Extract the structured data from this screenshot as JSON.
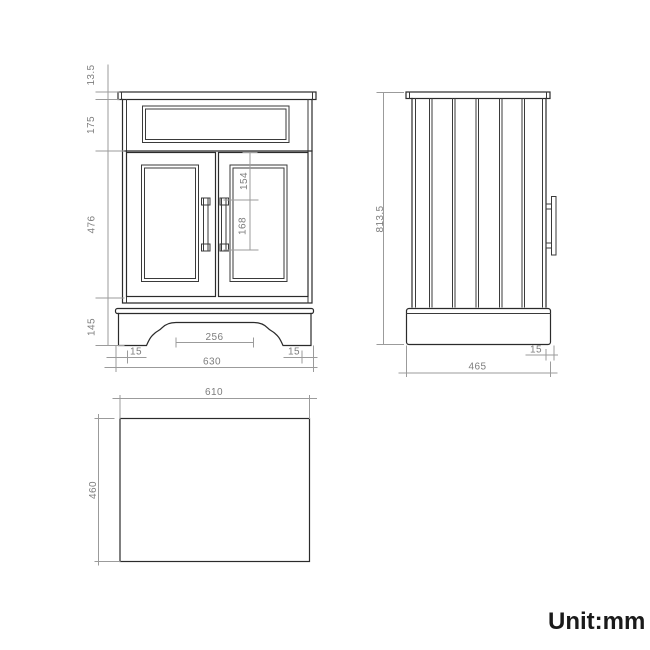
{
  "unit_label": "Unit:mm",
  "views": {
    "front": {
      "dims": {
        "countertop_thickness": "13.5",
        "upper_panel_height": "175",
        "door_height": "476",
        "base_height": "145",
        "door_top_to_handle": "154",
        "handle_length": "168",
        "base_cutout_width": "256",
        "base_margin_left": "15",
        "base_margin_right": "15",
        "overall_width": "630"
      }
    },
    "side": {
      "dims": {
        "overall_height": "813.5",
        "overall_depth": "465",
        "handle_projection": "15"
      }
    },
    "top": {
      "dims": {
        "countertop_width": "610",
        "countertop_depth": "460"
      }
    }
  },
  "colors": {
    "background": "#ffffff",
    "object_line": "#2b2b2b",
    "dimension_line": "#9b9b9b",
    "dimension_text": "#7d7d7d",
    "unit_text": "#1a1a1a"
  }
}
